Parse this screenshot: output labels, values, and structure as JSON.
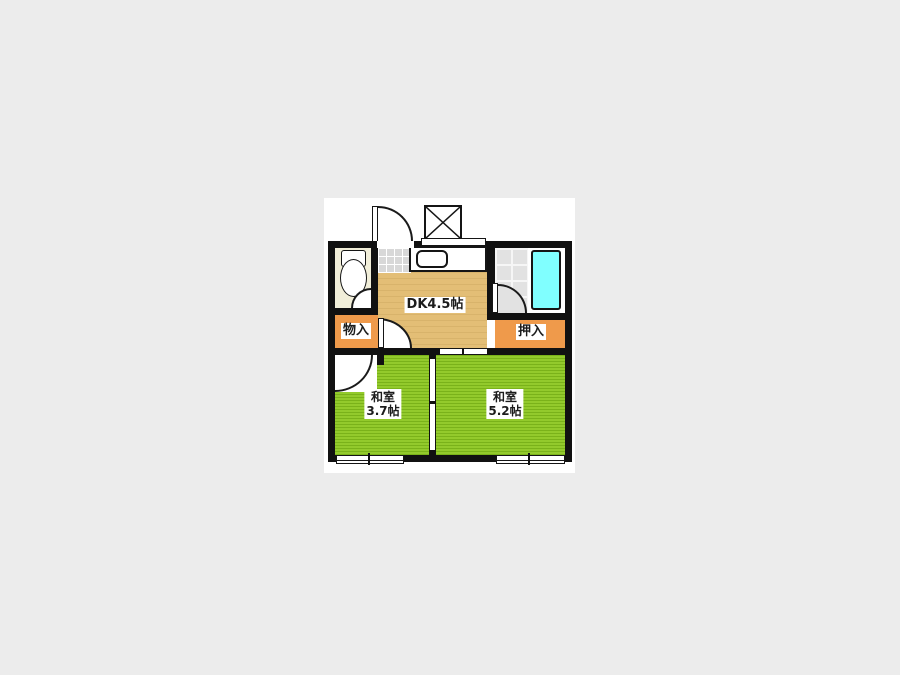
{
  "page": {
    "kind": "floor-plan"
  },
  "colors": {
    "page_bg": "#ececec",
    "canvas_bg": "#ffffff",
    "wall": "#111111",
    "dk_floor": "#e3be76",
    "tatami": "#8cc71f",
    "closet": "#ef9a4b",
    "toilet_floor": "#f1eed9",
    "tile": "#d8d8d8",
    "bath_tile": "#e2e2e2",
    "bathtub": "#80ffff",
    "label_bg": "#ffffff",
    "label_text": "#1c1c1c"
  },
  "rooms": {
    "dk": {
      "label": "DK4.5帖"
    },
    "washitsu_left": {
      "name": "和室",
      "size": "3.7帖"
    },
    "washitsu_right": {
      "name": "和室",
      "size": "5.2帖"
    },
    "storage_left": {
      "label": "物入"
    },
    "closet_right": {
      "label": "押入"
    }
  },
  "fixtures": {
    "toilet": "toilet",
    "kitchen_sink": "kitchen-sink-counter",
    "bathtub": "bathtub",
    "washer_pan": "washing-machine-pan",
    "entry_door": "entry-door-swing",
    "windows": "sliding-windows"
  }
}
